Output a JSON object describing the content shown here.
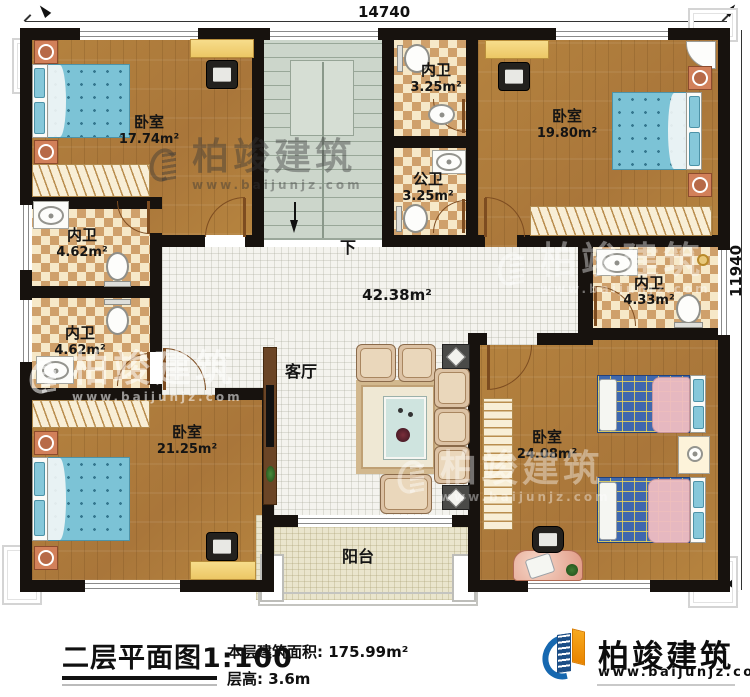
{
  "dimensions": {
    "top": "14740",
    "right": "11940"
  },
  "rooms": {
    "bedroom_tl": {
      "name": "卧室",
      "area": "17.74m²"
    },
    "bath_top": {
      "name": "内卫",
      "area": "3.25m²"
    },
    "bath_public": {
      "name": "公卫",
      "area": "3.25m²"
    },
    "bedroom_tr": {
      "name": "卧室",
      "area": "19.80m²"
    },
    "bath_left_upper": {
      "name": "内卫",
      "area": "4.62m²"
    },
    "bath_left_lower": {
      "name": "内卫",
      "area": "4.62m²"
    },
    "bath_right": {
      "name": "内卫",
      "area": "4.33m²"
    },
    "bedroom_bl": {
      "name": "卧室",
      "area": "21.25m²"
    },
    "bedroom_br": {
      "name": "卧室",
      "area": "24.08m²"
    },
    "living": {
      "name": "客厅",
      "area": "42.38m²"
    },
    "balcony": {
      "name": "阳台"
    },
    "stairs": {
      "direction_label": "下"
    }
  },
  "watermark": {
    "brand": "柏竣建筑",
    "site": "www.baijunjz.com"
  },
  "footer": {
    "plan_title": "二层平面图1:100",
    "floor_area_label": "本层建筑面积: 175.99m²",
    "floor_height_label": "层高: 3.6m",
    "brand": "柏竣建筑",
    "site": "www.baijunjz.com"
  },
  "colors": {
    "wall": "#17120e",
    "wood": "#b1803f",
    "tile": "#f4f3ee",
    "checker_light": "#f6e8c8",
    "checker_dark": "#cfa06b",
    "stairs": "#ccd6cb",
    "balcony": "#eae5cd",
    "bed_blue": "#7cc3d6",
    "brand_blue": "#1668b0",
    "brand_orange": "#f29400"
  }
}
